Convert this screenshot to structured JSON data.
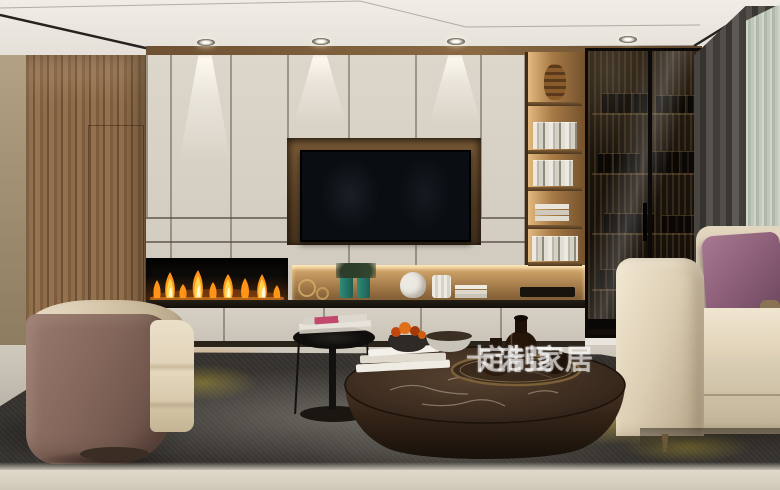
{
  "scene": {
    "type": "photorealistic interior render",
    "room": "modern living room with custom TV wall cabinetry",
    "watermark": {
      "brand": "卡诺亞",
      "tagline": "定制家居",
      "full_text": "卡诺亞 定制家居",
      "color": "#ffffff",
      "opacity": 0.58
    },
    "elements": [
      "tray ceiling with recessed downlights",
      "walnut wood wall panel",
      "cream lacquer cabinet wall",
      "recessed wood TV niche with black TV",
      "linear fireplace with flames",
      "lit display niche with green vases, white vases and books",
      "open wood bookshelf column with books",
      "smoked-glass display cabinet",
      "dark gray blackout curtain",
      "pale green sheer curtain",
      "beige fabric sofa",
      "purple accent pillow",
      "round stone barrel armchair",
      "dark marble round coffee table with bronze tray and vases",
      "black metal side table with magazines",
      "charcoal abstract rug with yellow accents",
      "light marble floor",
      "blurred foreground ledge"
    ],
    "palette": {
      "cabinet_cream": "#d9d3c7",
      "wood_brown": "#8a6747",
      "niche_wood": "#b3874f",
      "tv_black": "#0d1014",
      "flame_orange": "#ff9b1e",
      "flame_yellow": "#ffd34e",
      "sofa_beige": "#ddd0bb",
      "pillow_purple": "#8e6079",
      "chair_mauve": "#85685c",
      "rug_charcoal": "#302e2a",
      "rug_yellow": "#c3ad3a",
      "curtain_gray": "#4a4743",
      "sheer_green": "#c8d0c2",
      "floor_greige": "#c7c1b5",
      "marble_table_brown": "#3a2a1d"
    }
  }
}
